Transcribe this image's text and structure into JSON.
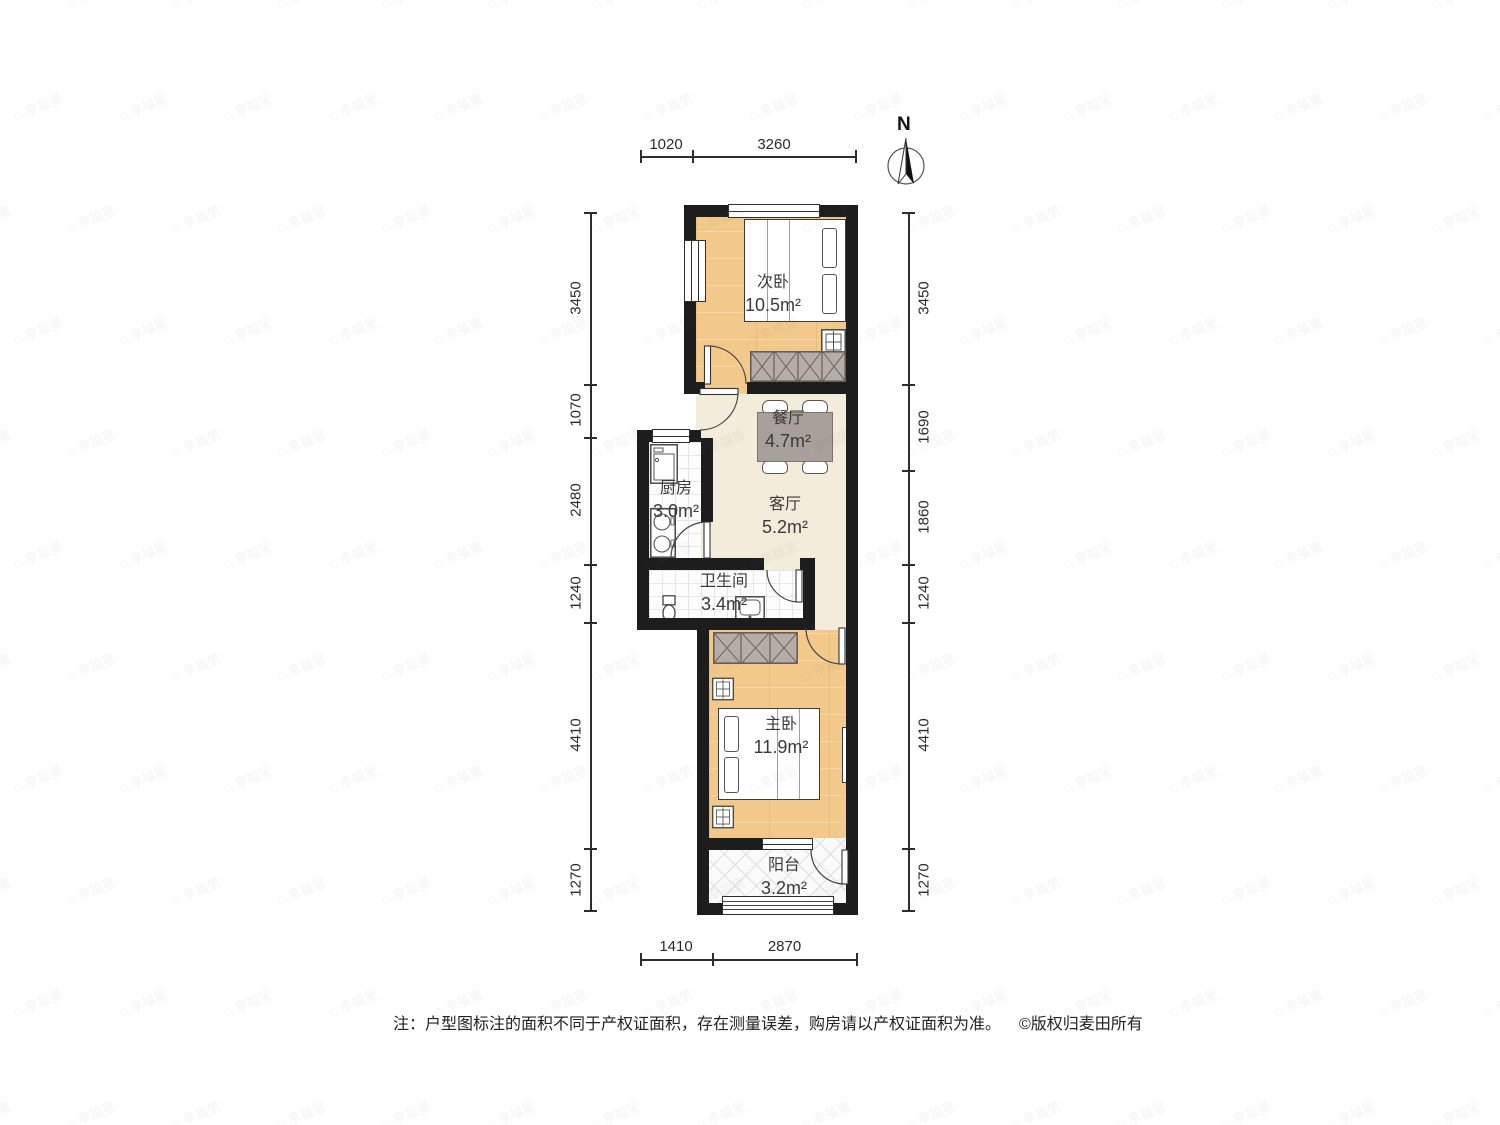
{
  "watermark": {
    "text": "幸福里",
    "icon": "⌂"
  },
  "compass": {
    "north_label": "N"
  },
  "dimensions": {
    "top": [
      "1020",
      "3260"
    ],
    "bottom": [
      "1410",
      "2870"
    ],
    "left": [
      "3450",
      "1070",
      "2480",
      "1240",
      "4410",
      "1270"
    ],
    "right": [
      "3450",
      "1690",
      "1860",
      "1240",
      "4410",
      "1270"
    ]
  },
  "rooms": {
    "second_bedroom": {
      "name": "次卧",
      "area": "10.5m²"
    },
    "dining": {
      "name": "餐厅",
      "area": "4.7m²"
    },
    "kitchen": {
      "name": "厨房",
      "area": "3.0m²"
    },
    "living": {
      "name": "客厅",
      "area": "5.2m²"
    },
    "bathroom": {
      "name": "卫生间",
      "area": "3.4m²"
    },
    "master_bedroom": {
      "name": "主卧",
      "area": "11.9m²"
    },
    "balcony": {
      "name": "阳台",
      "area": "3.2m²"
    }
  },
  "footer": {
    "note": "注：户型图标注的面积不同于产权证面积，存在测量误差，购房请以产权证面积为准。",
    "copyright": "©版权归麦田所有"
  }
}
